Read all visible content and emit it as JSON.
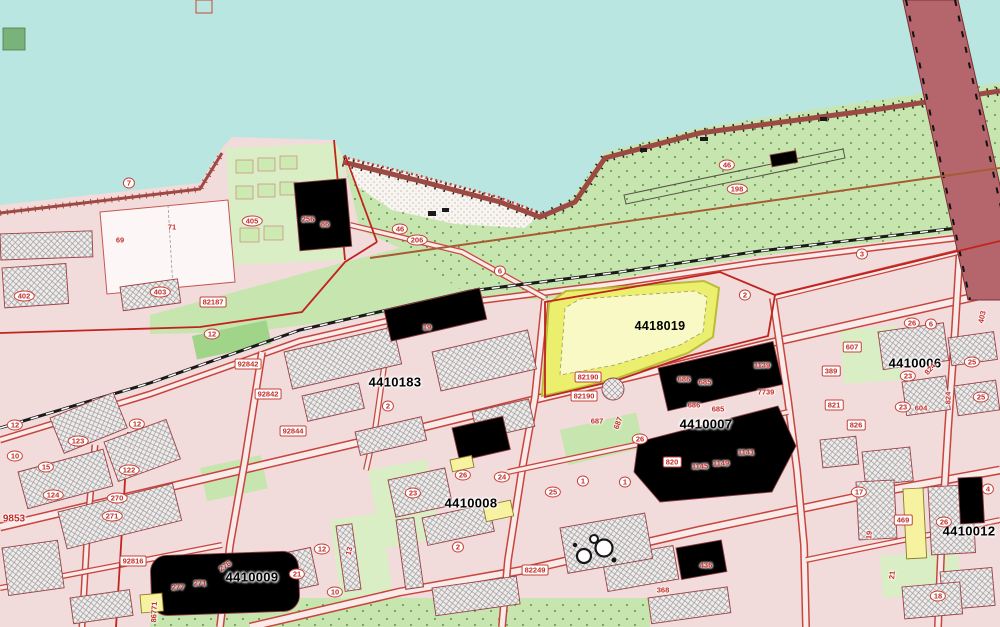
{
  "map": {
    "type": "cadastral-map",
    "selected_parcel": "4418019",
    "colors": {
      "water": "#b9e6e1",
      "land": "#f2dbdb",
      "green": "#c7e5ae",
      "green2": "#daeec6",
      "green3": "#9fd489",
      "sand": "#f8f4ef",
      "red": "#c8453d",
      "boundary": "#c0241f",
      "brown": "#a85a32",
      "bridge": "#b4666c",
      "bldg_dark": "#c4848a",
      "parcel_fill": "#ecee6e",
      "parcel_inner": "#f8f9c4",
      "quarter_label": "#d58a84",
      "highlight_label": "#c0532a"
    },
    "labels": {
      "highlight": {
        "t": "4418019",
        "x": 660,
        "y": 326
      },
      "quarters": [
        {
          "t": "4410183",
          "x": 395,
          "y": 382
        },
        {
          "t": "4410007",
          "x": 706,
          "y": 424
        },
        {
          "t": "4410008",
          "x": 471,
          "y": 503
        },
        {
          "t": "4410009",
          "x": 252,
          "y": 577
        },
        {
          "t": "4410006",
          "x": 915,
          "y": 363
        },
        {
          "t": "4410012",
          "x": 969,
          "y": 531
        }
      ],
      "pills": [
        {
          "t": "82187",
          "x": 213,
          "y": 302
        },
        {
          "t": "92842",
          "x": 248,
          "y": 364
        },
        {
          "t": "92842",
          "x": 268,
          "y": 394
        },
        {
          "t": "92844",
          "x": 293,
          "y": 431
        },
        {
          "t": "82190",
          "x": 588,
          "y": 377
        },
        {
          "t": "82190",
          "x": 584,
          "y": 396
        },
        {
          "t": "82249",
          "x": 535,
          "y": 570
        },
        {
          "t": "92816",
          "x": 133,
          "y": 561
        },
        {
          "t": "820",
          "x": 672,
          "y": 462
        },
        {
          "t": "607",
          "x": 852,
          "y": 347
        },
        {
          "t": "389",
          "x": 831,
          "y": 371
        },
        {
          "t": "821",
          "x": 834,
          "y": 405
        },
        {
          "t": "826",
          "x": 856,
          "y": 425
        },
        {
          "t": "469",
          "x": 903,
          "y": 520
        }
      ],
      "numbers": [
        {
          "t": "69",
          "x": 120,
          "y": 240
        },
        {
          "t": "71",
          "x": 172,
          "y": 227
        },
        {
          "t": "7",
          "x": 129,
          "y": 183,
          "o": 1
        },
        {
          "t": "402",
          "x": 24,
          "y": 296,
          "o": 1
        },
        {
          "t": "403",
          "x": 160,
          "y": 292,
          "o": 1
        },
        {
          "t": "405",
          "x": 252,
          "y": 221,
          "o": 1
        },
        {
          "t": "256",
          "x": 308,
          "y": 219
        },
        {
          "t": "86",
          "x": 325,
          "y": 224
        },
        {
          "t": "46",
          "x": 400,
          "y": 229,
          "o": 1
        },
        {
          "t": "206",
          "x": 417,
          "y": 240,
          "o": 1
        },
        {
          "t": "46",
          "x": 727,
          "y": 165,
          "o": 1
        },
        {
          "t": "198",
          "x": 737,
          "y": 189,
          "o": 1
        },
        {
          "t": "6",
          "x": 500,
          "y": 271,
          "o": 1
        },
        {
          "t": "3",
          "x": 862,
          "y": 254,
          "o": 1
        },
        {
          "t": "2",
          "x": 745,
          "y": 295,
          "o": 1
        },
        {
          "t": "2",
          "x": 388,
          "y": 406,
          "o": 1
        },
        {
          "t": "12",
          "x": 212,
          "y": 334,
          "o": 1
        },
        {
          "t": "12",
          "x": 15,
          "y": 425,
          "o": 1
        },
        {
          "t": "12",
          "x": 137,
          "y": 424,
          "o": 1
        },
        {
          "t": "19",
          "x": 427,
          "y": 327
        },
        {
          "t": "123",
          "x": 78,
          "y": 441,
          "o": 1
        },
        {
          "t": "122",
          "x": 129,
          "y": 470,
          "o": 1
        },
        {
          "t": "124",
          "x": 53,
          "y": 495,
          "o": 1
        },
        {
          "t": "270",
          "x": 117,
          "y": 498,
          "o": 1
        },
        {
          "t": "271",
          "x": 112,
          "y": 516,
          "o": 1
        },
        {
          "t": "10",
          "x": 15,
          "y": 456,
          "o": 1
        },
        {
          "t": "15",
          "x": 46,
          "y": 467,
          "o": 1
        },
        {
          "t": "9853",
          "x": 14,
          "y": 519,
          "big": 1
        },
        {
          "t": "686",
          "x": 684,
          "y": 379
        },
        {
          "t": "685",
          "x": 705,
          "y": 382
        },
        {
          "t": "686",
          "x": 694,
          "y": 405
        },
        {
          "t": "685",
          "x": 718,
          "y": 409
        },
        {
          "t": "687",
          "x": 597,
          "y": 421
        },
        {
          "t": "687",
          "x": 618,
          "y": 423,
          "r": -70
        },
        {
          "t": "1139",
          "x": 762,
          "y": 365
        },
        {
          "t": "7739",
          "x": 766,
          "y": 392
        },
        {
          "t": "26",
          "x": 640,
          "y": 439,
          "o": 1
        },
        {
          "t": "1145",
          "x": 700,
          "y": 466
        },
        {
          "t": "1149",
          "x": 721,
          "y": 463
        },
        {
          "t": "1141",
          "x": 746,
          "y": 452
        },
        {
          "t": "2",
          "x": 458,
          "y": 547,
          "o": 1
        },
        {
          "t": "1",
          "x": 583,
          "y": 481,
          "o": 1
        },
        {
          "t": "1",
          "x": 625,
          "y": 482,
          "o": 1
        },
        {
          "t": "23",
          "x": 413,
          "y": 493,
          "o": 1
        },
        {
          "t": "26",
          "x": 463,
          "y": 475,
          "o": 1
        },
        {
          "t": "24",
          "x": 502,
          "y": 477,
          "o": 1
        },
        {
          "t": "25",
          "x": 553,
          "y": 492,
          "o": 1
        },
        {
          "t": "21",
          "x": 297,
          "y": 574,
          "o": 1
        },
        {
          "t": "12",
          "x": 322,
          "y": 549,
          "o": 1
        },
        {
          "t": "10",
          "x": 335,
          "y": 592,
          "o": 1
        },
        {
          "t": "13",
          "x": 349,
          "y": 551,
          "r": -75
        },
        {
          "t": "277",
          "x": 178,
          "y": 587
        },
        {
          "t": "271",
          "x": 200,
          "y": 583
        },
        {
          "t": "276",
          "x": 225,
          "y": 566,
          "r": -35
        },
        {
          "t": "368",
          "x": 663,
          "y": 590
        },
        {
          "t": "436",
          "x": 706,
          "y": 565
        },
        {
          "t": "17",
          "x": 859,
          "y": 492,
          "o": 1
        },
        {
          "t": "26",
          "x": 944,
          "y": 522,
          "o": 1
        },
        {
          "t": "19",
          "x": 869,
          "y": 535,
          "r": -85
        },
        {
          "t": "21",
          "x": 892,
          "y": 575,
          "r": -85
        },
        {
          "t": "18",
          "x": 938,
          "y": 596,
          "o": 1
        },
        {
          "t": "4",
          "x": 988,
          "y": 489,
          "o": 1
        },
        {
          "t": "26",
          "x": 912,
          "y": 323,
          "o": 1
        },
        {
          "t": "6",
          "x": 931,
          "y": 324,
          "o": 1
        },
        {
          "t": "25",
          "x": 972,
          "y": 362,
          "o": 1
        },
        {
          "t": "25",
          "x": 981,
          "y": 397,
          "o": 1
        },
        {
          "t": "23",
          "x": 908,
          "y": 376,
          "o": 1
        },
        {
          "t": "23",
          "x": 903,
          "y": 407,
          "o": 1
        },
        {
          "t": "604",
          "x": 921,
          "y": 408
        },
        {
          "t": "824",
          "x": 930,
          "y": 369,
          "r": -50
        },
        {
          "t": "824",
          "x": 948,
          "y": 398,
          "r": -90
        },
        {
          "t": "403",
          "x": 982,
          "y": 317,
          "r": -78
        },
        {
          "t": "86771",
          "x": 154,
          "y": 612,
          "r": -88
        }
      ]
    }
  }
}
